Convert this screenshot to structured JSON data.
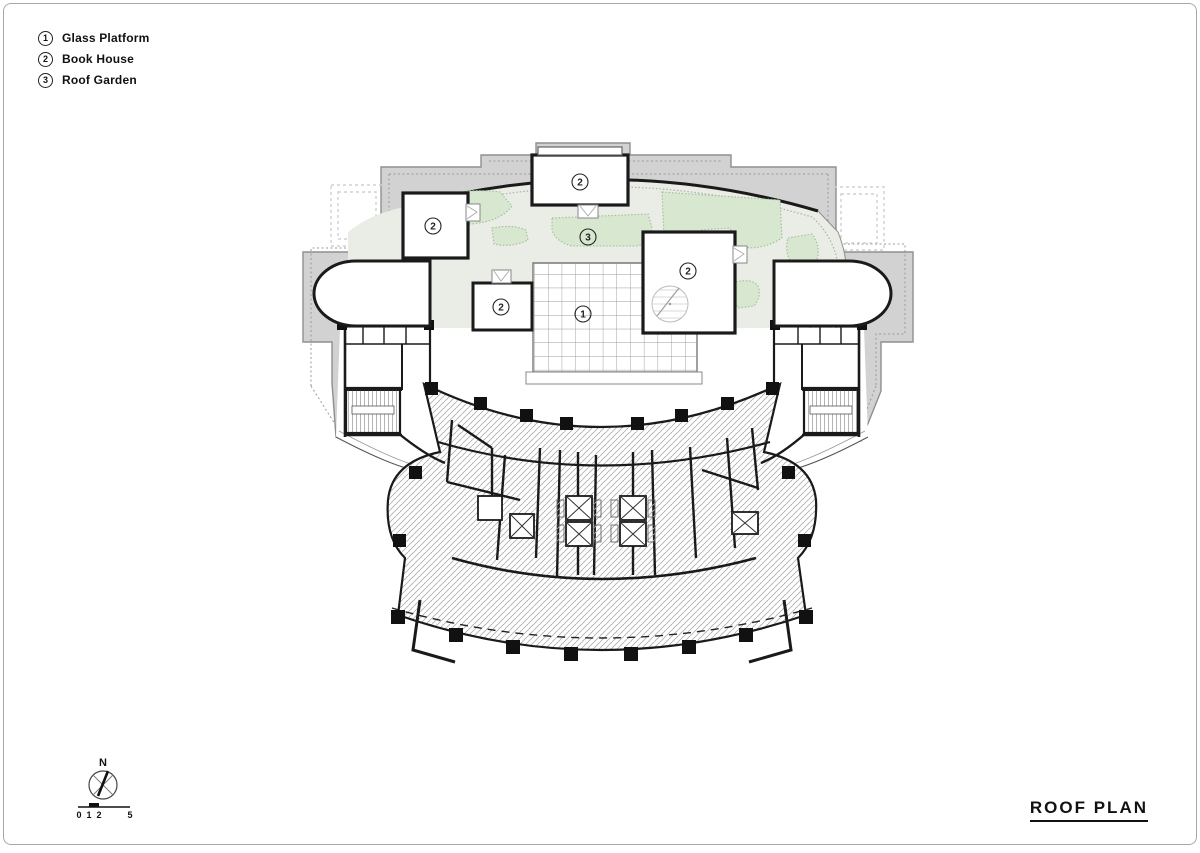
{
  "page": {
    "title": "ROOF PLAN"
  },
  "legend": {
    "items": [
      {
        "num": "1",
        "label": "Glass Platform"
      },
      {
        "num": "2",
        "label": "Book House"
      },
      {
        "num": "3",
        "label": "Roof Garden"
      }
    ]
  },
  "compass": {
    "north_label": "N"
  },
  "scalebar": {
    "ticks": [
      "0",
      "1",
      "2",
      "5"
    ]
  },
  "plan": {
    "labels": [
      {
        "num": "1",
        "x": 583,
        "y": 314
      },
      {
        "num": "2",
        "x": 580,
        "y": 182
      },
      {
        "num": "2",
        "x": 433,
        "y": 226
      },
      {
        "num": "2",
        "x": 501,
        "y": 307
      },
      {
        "num": "2",
        "x": 688,
        "y": 271
      },
      {
        "num": "3",
        "x": 588,
        "y": 237
      }
    ]
  },
  "colors": {
    "parapet": "#d2d2d2",
    "garden": "#eaece6",
    "planting": "#d8e7d0",
    "wall": "#1a1a1a",
    "hatch": "#b0b0b0"
  }
}
